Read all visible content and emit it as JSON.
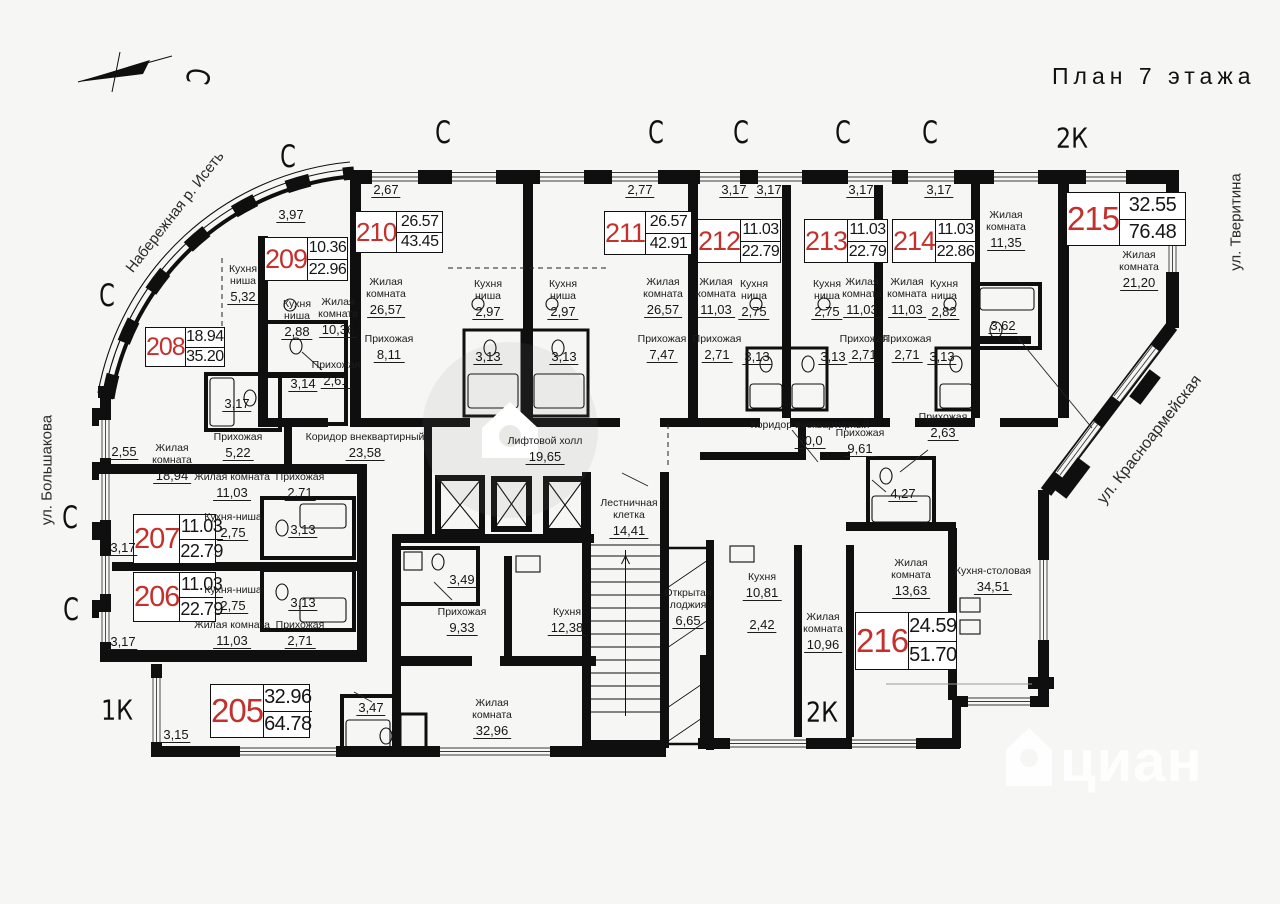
{
  "title": "План 7 этажа",
  "watermark": {
    "bottom_text": "циан"
  },
  "streets": [
    {
      "text": "Набережная р. Исеть",
      "x": 175,
      "y": 212,
      "rot": -52,
      "fs": 15
    },
    {
      "text": "ул. Большакова",
      "x": 47,
      "y": 470,
      "rot": -90,
      "fs": 15
    },
    {
      "text": "ул. Тверитина",
      "x": 1236,
      "y": 222,
      "rot": -90,
      "fs": 15
    },
    {
      "text": "ул. Красноармейская",
      "x": 1150,
      "y": 440,
      "rot": -52,
      "fs": 16
    }
  ],
  "type_labels": [
    {
      "text": "2К",
      "x": 1072,
      "y": 138
    },
    {
      "text": "2К",
      "x": 822,
      "y": 712
    },
    {
      "text": "1К",
      "x": 117,
      "y": 710
    }
  ],
  "marks": [
    {
      "t": "С",
      "x": 288,
      "y": 157,
      "rot": 0
    },
    {
      "t": "С",
      "x": 443,
      "y": 133,
      "rot": 0
    },
    {
      "t": "С",
      "x": 656,
      "y": 133,
      "rot": 0
    },
    {
      "t": "С",
      "x": 741,
      "y": 133,
      "rot": 0
    },
    {
      "t": "С",
      "x": 843,
      "y": 133,
      "rot": 0
    },
    {
      "t": "С",
      "x": 930,
      "y": 133,
      "rot": 0
    },
    {
      "t": "С",
      "x": 107,
      "y": 296,
      "rot": 0
    },
    {
      "t": "С",
      "x": 70,
      "y": 518,
      "rot": 0
    },
    {
      "t": "С",
      "x": 71,
      "y": 610,
      "rot": 0
    },
    {
      "t": "С",
      "x": 197,
      "y": 76,
      "rot": 100
    }
  ],
  "apartments": [
    {
      "num": "205",
      "v1": "32.96",
      "v2": "64.78",
      "x": 210,
      "y": 684,
      "w": 100,
      "h": 54,
      "fs": 33,
      "vfs": 20
    },
    {
      "num": "206",
      "v1": "11.03",
      "v2": "22.79",
      "x": 133,
      "y": 572,
      "w": 83,
      "h": 50,
      "fs": 29,
      "vfs": 18
    },
    {
      "num": "207",
      "v1": "11.03",
      "v2": "22.79",
      "x": 133,
      "y": 514,
      "w": 83,
      "h": 50,
      "fs": 29,
      "vfs": 18
    },
    {
      "num": "208",
      "v1": "18.94",
      "v2": "35.20",
      "x": 145,
      "y": 327,
      "w": 80,
      "h": 40,
      "fs": 25,
      "vfs": 16
    },
    {
      "num": "209",
      "v1": "10.36",
      "v2": "22.96",
      "x": 264,
      "y": 237,
      "w": 84,
      "h": 44,
      "fs": 27,
      "vfs": 16
    },
    {
      "num": "210",
      "v1": "26.57",
      "v2": "43.45",
      "x": 355,
      "y": 211,
      "w": 88,
      "h": 42,
      "fs": 26,
      "vfs": 16
    },
    {
      "num": "211",
      "v1": "26.57",
      "v2": "42.91",
      "x": 604,
      "y": 211,
      "w": 88,
      "h": 44,
      "fs": 27,
      "vfs": 16
    },
    {
      "num": "212",
      "v1": "11.03",
      "v2": "22.79",
      "x": 697,
      "y": 219,
      "w": 84,
      "h": 44,
      "fs": 27,
      "vfs": 16
    },
    {
      "num": "213",
      "v1": "11.03",
      "v2": "22.79",
      "x": 804,
      "y": 219,
      "w": 84,
      "h": 44,
      "fs": 27,
      "vfs": 16
    },
    {
      "num": "214",
      "v1": "11.03",
      "v2": "22.86",
      "x": 892,
      "y": 219,
      "w": 84,
      "h": 44,
      "fs": 27,
      "vfs": 16
    },
    {
      "num": "215",
      "v1": "32.55",
      "v2": "76.48",
      "x": 1066,
      "y": 192,
      "w": 120,
      "h": 54,
      "fs": 33,
      "vfs": 20
    },
    {
      "num": "216",
      "v1": "24.59",
      "v2": "51.70",
      "x": 855,
      "y": 612,
      "w": 102,
      "h": 58,
      "fs": 33,
      "vfs": 20
    }
  ],
  "rooms": [
    {
      "lines": [
        "Кухня",
        "ниша"
      ],
      "area": "5,32",
      "x": 243,
      "y": 264
    },
    {
      "lines": [
        "Кухня",
        "ниша"
      ],
      "area": "2,88",
      "x": 297,
      "y": 299
    },
    {
      "lines": [
        "Жилая",
        "комната"
      ],
      "area": "10,36",
      "x": 338,
      "y": 297
    },
    {
      "lines": [
        "Прихожая"
      ],
      "area": "2,61",
      "x": 336,
      "y": 360
    },
    {
      "lines": [
        "Жилая",
        "комната"
      ],
      "area": "18,94",
      "x": 172,
      "y": 443
    },
    {
      "lines": [
        "Прихожая"
      ],
      "area": "5,22",
      "x": 238,
      "y": 432
    },
    {
      "lines": [
        "Жилая",
        "комната"
      ],
      "area": "26,57",
      "x": 386,
      "y": 277
    },
    {
      "lines": [
        "Прихожая"
      ],
      "area": "8,11",
      "x": 389,
      "y": 334
    },
    {
      "lines": [
        "Кухня",
        "ниша"
      ],
      "area": "2,97",
      "x": 488,
      "y": 279
    },
    {
      "lines": [
        "Кухня",
        "ниша"
      ],
      "area": "2,97",
      "x": 563,
      "y": 279
    },
    {
      "lines": [
        "Жилая",
        "комната"
      ],
      "area": "26,57",
      "x": 663,
      "y": 277
    },
    {
      "lines": [
        "Прихожая"
      ],
      "area": "7,47",
      "x": 662,
      "y": 334
    },
    {
      "lines": [
        "Жилая",
        "комната"
      ],
      "area": "11,03",
      "x": 716,
      "y": 277
    },
    {
      "lines": [
        "Кухня",
        "ниша"
      ],
      "area": "2,75",
      "x": 754,
      "y": 279
    },
    {
      "lines": [
        "Прихожая"
      ],
      "area": "2,71",
      "x": 717,
      "y": 334
    },
    {
      "lines": [
        "Кухня",
        "ниша"
      ],
      "area": "2,75",
      "x": 827,
      "y": 279
    },
    {
      "lines": [
        "Жилая",
        "комната"
      ],
      "area": "11,03",
      "x": 862,
      "y": 277
    },
    {
      "lines": [
        "Прихожая"
      ],
      "area": "2,71",
      "x": 864,
      "y": 334
    },
    {
      "lines": [
        "Жилая",
        "комната"
      ],
      "area": "11,03",
      "x": 907,
      "y": 277
    },
    {
      "lines": [
        "Кухня",
        "ниша"
      ],
      "area": "2,82",
      "x": 944,
      "y": 279
    },
    {
      "lines": [
        "Прихожая"
      ],
      "area": "2,71",
      "x": 907,
      "y": 334
    },
    {
      "lines": [
        "Жилая",
        "комната"
      ],
      "area": "11,35",
      "x": 1006,
      "y": 210
    },
    {
      "lines": [
        "Жилая",
        "комната"
      ],
      "area": "21,20",
      "x": 1139,
      "y": 250
    },
    {
      "lines": [
        "Кухня-столовая"
      ],
      "area": "34,51",
      "x": 993,
      "y": 566
    },
    {
      "lines": [
        "Прихожая"
      ],
      "area": "2,63",
      "x": 943,
      "y": 412
    },
    {
      "lines": [
        "Коридор внеквартирный"
      ],
      "area": "23,58",
      "x": 365,
      "y": 432
    },
    {
      "lines": [
        "Коридор внеквартирный"
      ],
      "area": "20,0",
      "x": 810,
      "y": 420
    },
    {
      "lines": [
        "Лифтовой холл"
      ],
      "area": "19,65",
      "x": 545,
      "y": 436
    },
    {
      "lines": [
        "Лестничная",
        "клетка"
      ],
      "area": "14,41",
      "x": 629,
      "y": 498
    },
    {
      "lines": [
        "Открытая",
        "лоджия"
      ],
      "area": "6,65",
      "x": 688,
      "y": 588
    },
    {
      "lines": [
        "Кухня"
      ],
      "area": "10,81",
      "x": 762,
      "y": 572
    },
    {
      "lines": [
        "Жилая",
        "комната"
      ],
      "area": "10,96",
      "x": 823,
      "y": 612
    },
    {
      "lines": [
        "Жилая",
        "комната"
      ],
      "area": "13,63",
      "x": 911,
      "y": 558
    },
    {
      "lines": [
        "Прихожая"
      ],
      "area": "9,61",
      "x": 860,
      "y": 428
    },
    {
      "lines": [
        "Прихожая"
      ],
      "area": "9,33",
      "x": 462,
      "y": 607
    },
    {
      "lines": [
        "Кухня"
      ],
      "area": "12,38",
      "x": 567,
      "y": 607
    },
    {
      "lines": [
        "Жилая",
        "комната"
      ],
      "area": "32,96",
      "x": 492,
      "y": 698
    },
    {
      "lines": [
        "Жилая комната"
      ],
      "area": "11,03",
      "x": 232,
      "y": 472
    },
    {
      "lines": [
        "Прихожая"
      ],
      "area": "2,71",
      "x": 300,
      "y": 472
    },
    {
      "lines": [
        "Кухня-ниша"
      ],
      "area": "2,75",
      "x": 233,
      "y": 512
    },
    {
      "lines": [
        "Кухня-ниша"
      ],
      "area": "2,75",
      "x": 233,
      "y": 585
    },
    {
      "lines": [
        "Жилая комната"
      ],
      "area": "11,03",
      "x": 232,
      "y": 620
    },
    {
      "lines": [
        "Прихожая"
      ],
      "area": "2,71",
      "x": 300,
      "y": 620
    }
  ],
  "dims": [
    {
      "v": "3,97",
      "x": 291,
      "y": 207
    },
    {
      "v": "2,67",
      "x": 386,
      "y": 182
    },
    {
      "v": "2,77",
      "x": 640,
      "y": 182
    },
    {
      "v": "3,17",
      "x": 734,
      "y": 182
    },
    {
      "v": "3,17",
      "x": 769,
      "y": 182
    },
    {
      "v": "3,17",
      "x": 861,
      "y": 182
    },
    {
      "v": "3,17",
      "x": 939,
      "y": 182
    },
    {
      "v": "2,55",
      "x": 124,
      "y": 444
    },
    {
      "v": "3,17",
      "x": 123,
      "y": 540
    },
    {
      "v": "3,17",
      "x": 123,
      "y": 634
    },
    {
      "v": "3,15",
      "x": 176,
      "y": 727
    },
    {
      "v": "3,17",
      "x": 237,
      "y": 396
    },
    {
      "v": "3,14",
      "x": 303,
      "y": 376
    },
    {
      "v": "3,13",
      "x": 488,
      "y": 349
    },
    {
      "v": "3,13",
      "x": 564,
      "y": 349
    },
    {
      "v": "3,13",
      "x": 757,
      "y": 349
    },
    {
      "v": "3,13",
      "x": 833,
      "y": 349
    },
    {
      "v": "3,13",
      "x": 942,
      "y": 349
    },
    {
      "v": "3,13",
      "x": 303,
      "y": 522
    },
    {
      "v": "3,13",
      "x": 303,
      "y": 595
    },
    {
      "v": "3,62",
      "x": 1003,
      "y": 318
    },
    {
      "v": "3,49",
      "x": 462,
      "y": 572
    },
    {
      "v": "3,47",
      "x": 371,
      "y": 700
    },
    {
      "v": "4,27",
      "x": 903,
      "y": 486
    },
    {
      "v": "2,42",
      "x": 762,
      "y": 617
    }
  ]
}
